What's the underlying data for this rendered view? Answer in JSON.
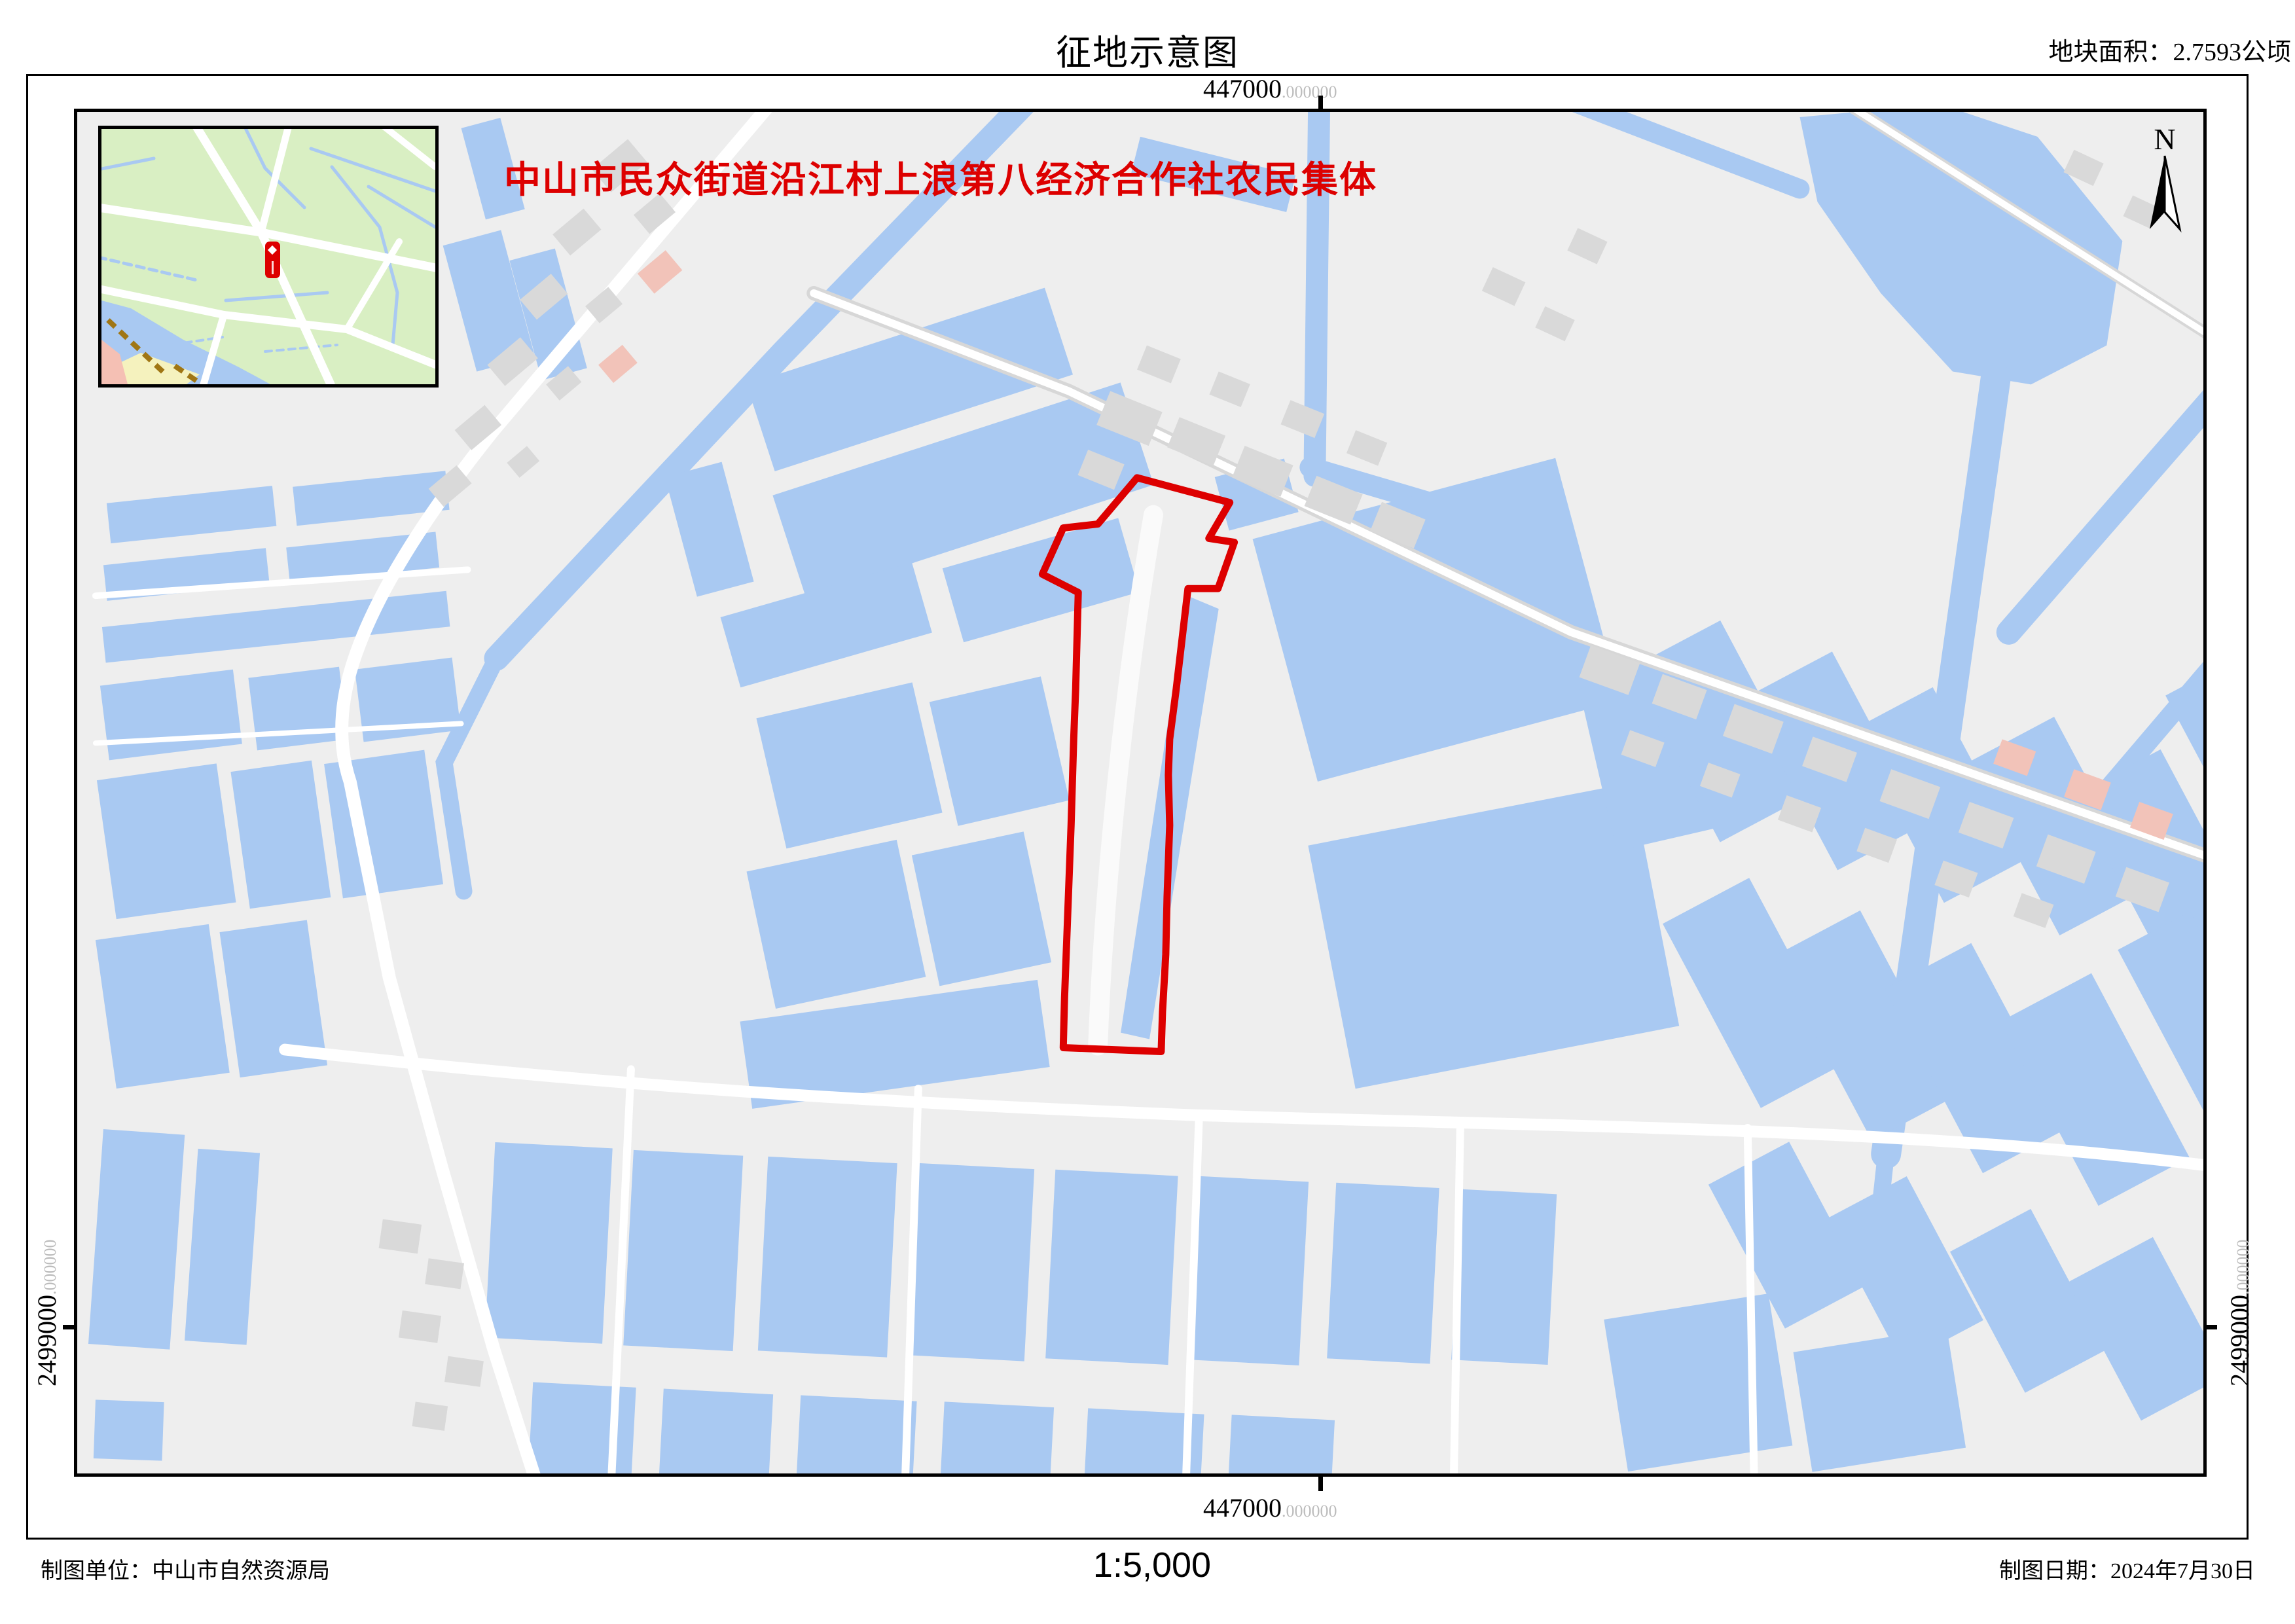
{
  "page": {
    "title": "征地示意图",
    "area_label": "地块面积：2.7593公顷"
  },
  "map": {
    "owner_label": "中山市民众街道沿江村上浪第八经济合作社农民集体",
    "north_label": "N"
  },
  "grid": {
    "easting": "447000",
    "easting_decimal": ".000000",
    "northing": "2499000",
    "northing_decimal": ".000000"
  },
  "footer": {
    "agency": "制图单位：中山市自然资源局",
    "scale": "1:5,000",
    "date": "制图日期：2024年7月30日"
  },
  "colors": {
    "water": "#a9c9f2",
    "map_bg": "#eeeeee",
    "road": "#ffffff",
    "building": "#d9d9d9",
    "building_alt": "#f2c3b9",
    "parcel": "#dd0000",
    "inset_green": "#d9efc3",
    "inset_pink": "#f5c0b4",
    "inset_yellow": "#f5f2be",
    "inset_brown": "#a07614",
    "grid_gray": "#bdbdbd",
    "text": "#000000"
  }
}
